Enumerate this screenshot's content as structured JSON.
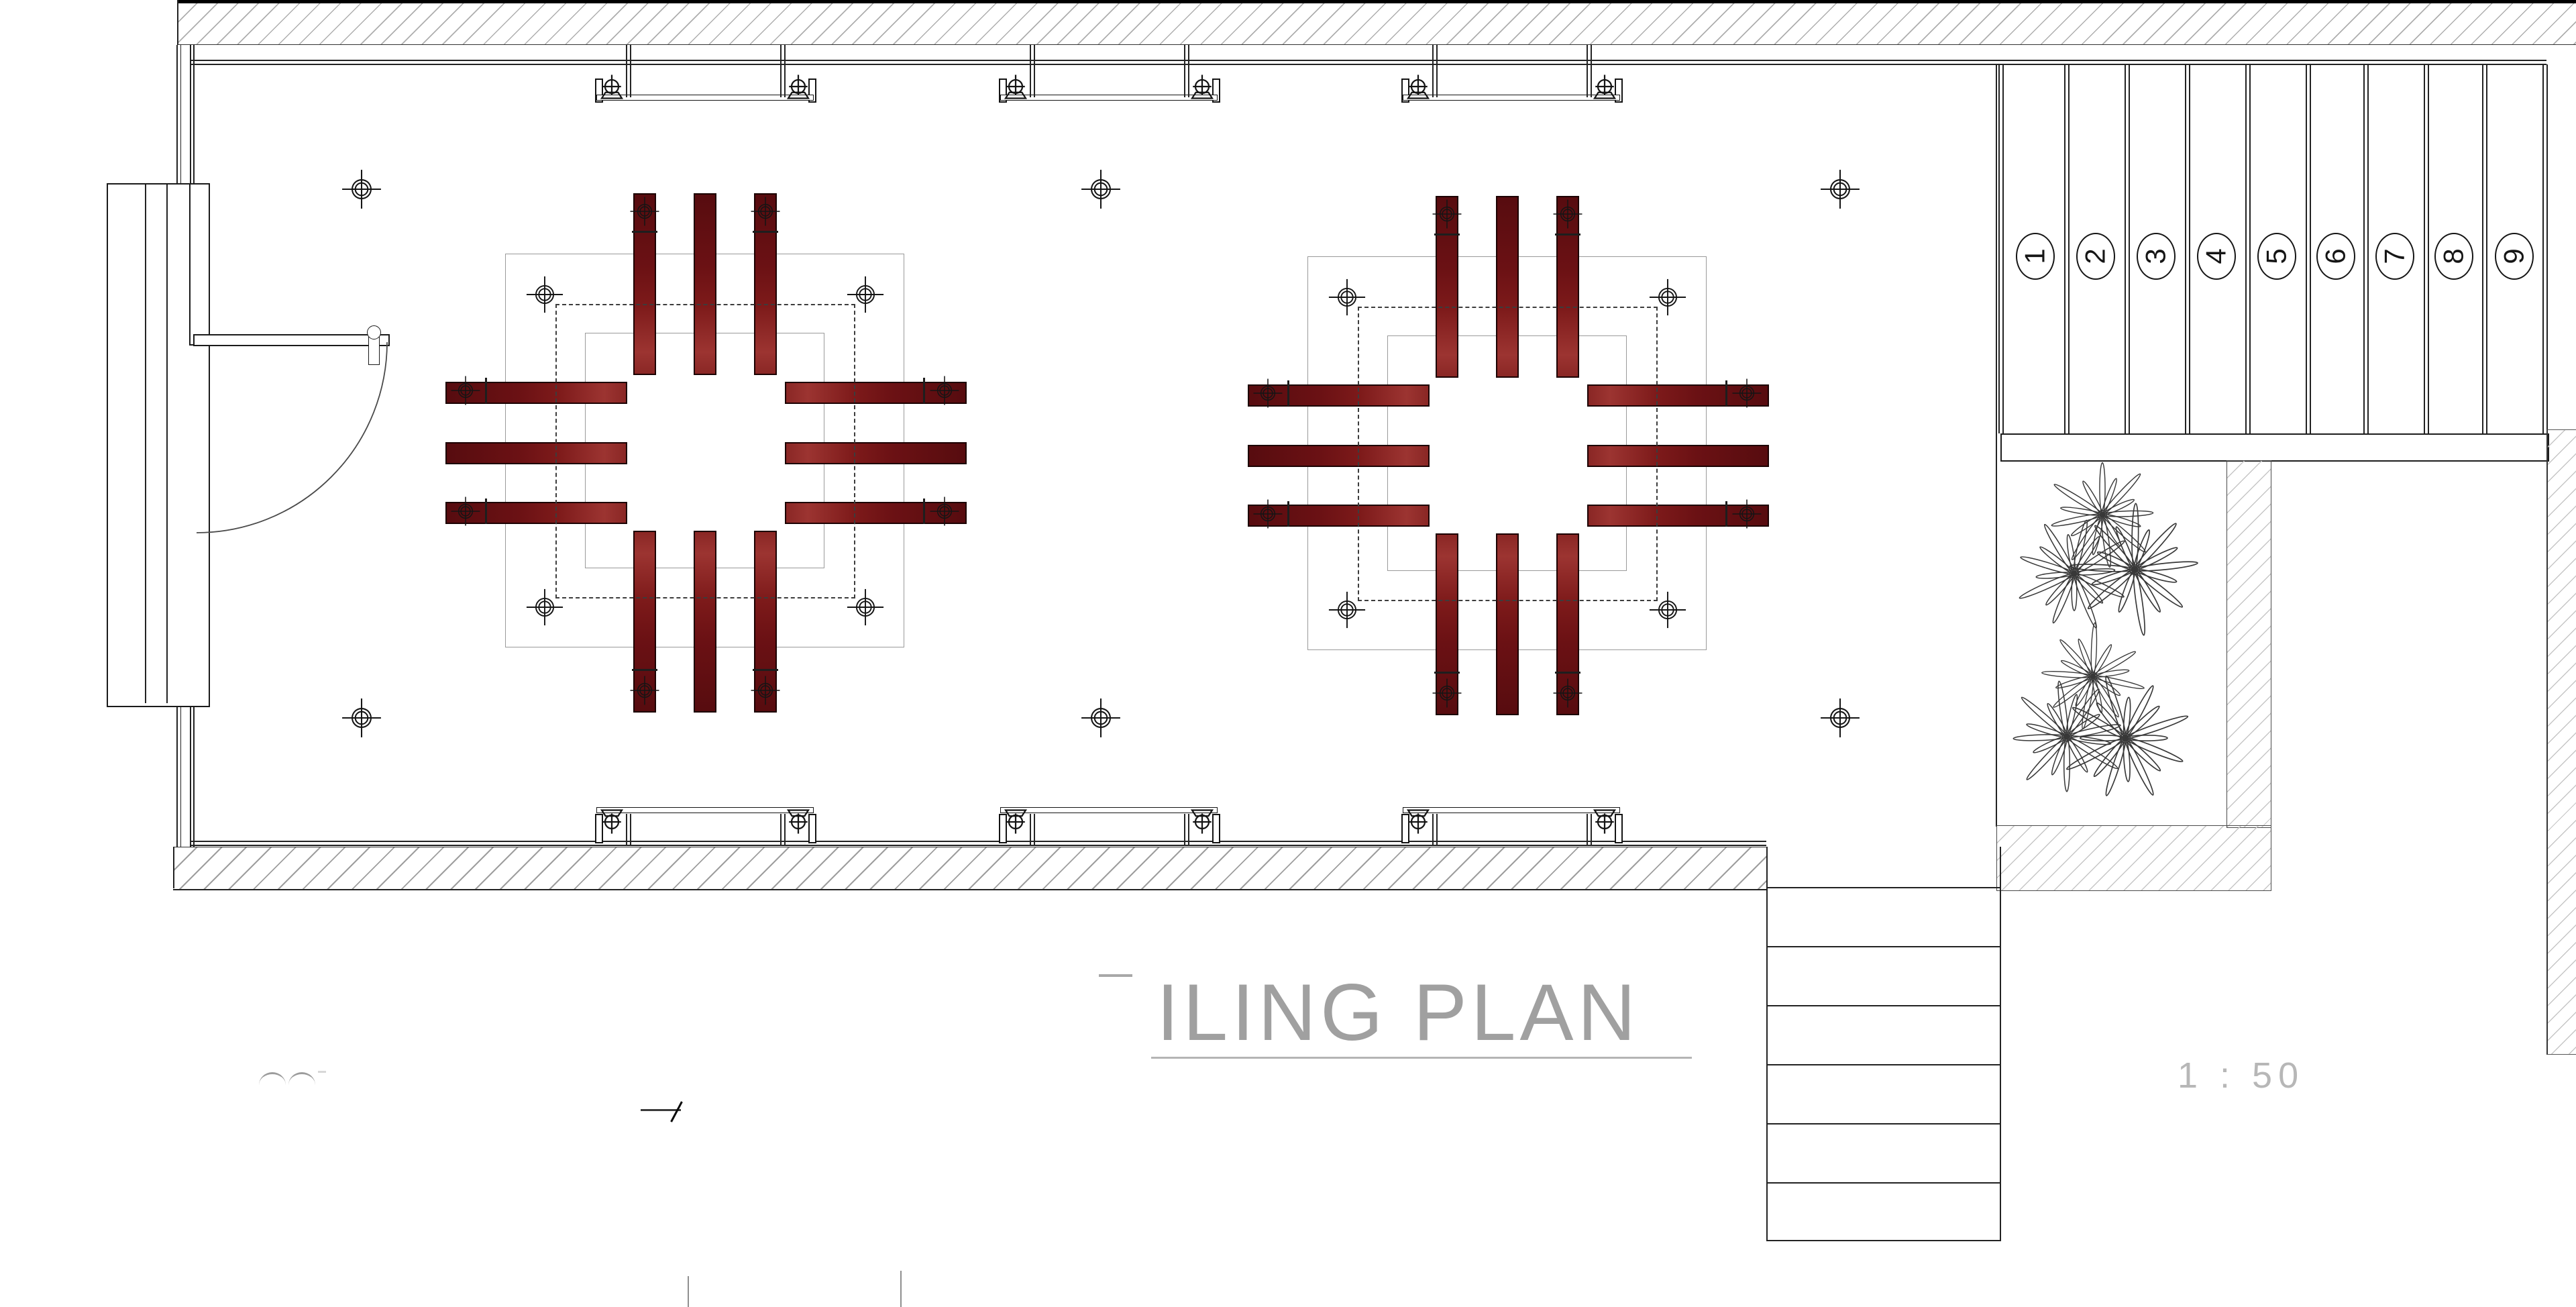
{
  "title_block": {
    "visible_title": "ILING PLAN",
    "scale_label": "1 : 50"
  },
  "deck_panel_labels": [
    "1",
    "2",
    "3",
    "4",
    "5",
    "6",
    "7",
    "8",
    "9"
  ],
  "colors": {
    "beam_red_dark": "#570c0f",
    "beam_red_light": "#9c3431",
    "drawing_line": "#1a1a1a",
    "guide_gray": "#9a9a9a",
    "dashed_guide": "#3c3c3c",
    "hatch_gray": "#aeaeae",
    "faint_text_gray": "#a0a0a0"
  },
  "symbols": {
    "ceiling_light_marker": "circle-cross-target",
    "blind_roller": "roller-with-bracket",
    "plant": "starburst-shrub",
    "door": "quarter-arc-swing-door",
    "stairs": "straight-run-5-treads"
  }
}
